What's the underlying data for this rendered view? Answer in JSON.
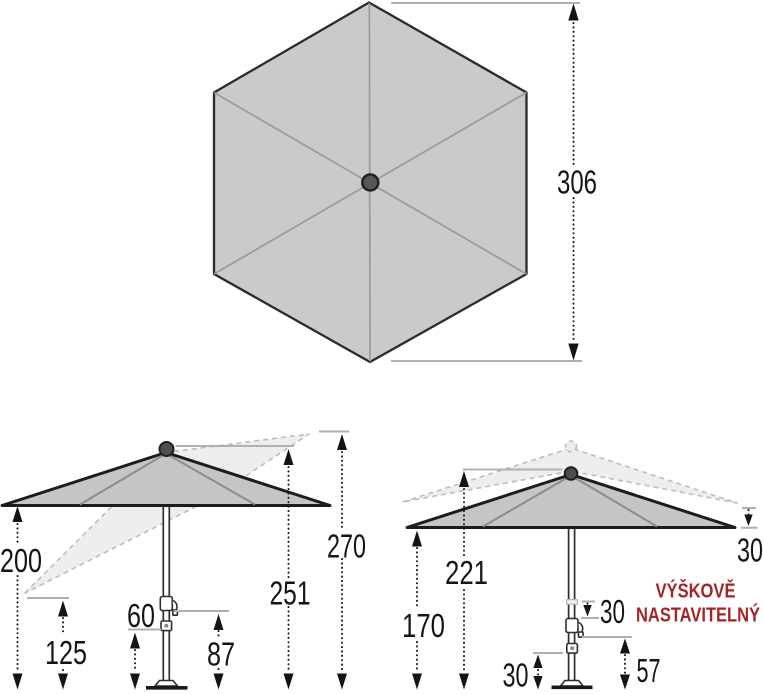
{
  "colors": {
    "canopy_fill": "#c5c5c5",
    "hexagon_fill": "#cacaca",
    "ghost_fill": "#eeeeee",
    "ghost_stroke": "#bdbdbd",
    "outline": "#1c1c1c",
    "rib_gray": "#8c8c8c",
    "tick_gray": "#b0b0b0",
    "dimension_text": "#151515",
    "note_red": "#a12626"
  },
  "top_view": {
    "dim_width": "306"
  },
  "tilt_view": {
    "dim_canopy_edge_height": "200",
    "dim_tilted_low_tip": "125",
    "dim_lower_hub": "60",
    "dim_crank_height": "87",
    "dim_top_height": "251",
    "dim_tilted_high_tip": "270"
  },
  "adjustable_view": {
    "dim_top_height": "221",
    "dim_canopy_edge_height": "170",
    "dim_canopy_drop": "30",
    "dim_slider_travel": "30",
    "dim_lower_hub": "30",
    "dim_crank_height": "57",
    "note_line1": "VÝŠKOVĚ",
    "note_line2": "NASTAVITELNÝ"
  }
}
